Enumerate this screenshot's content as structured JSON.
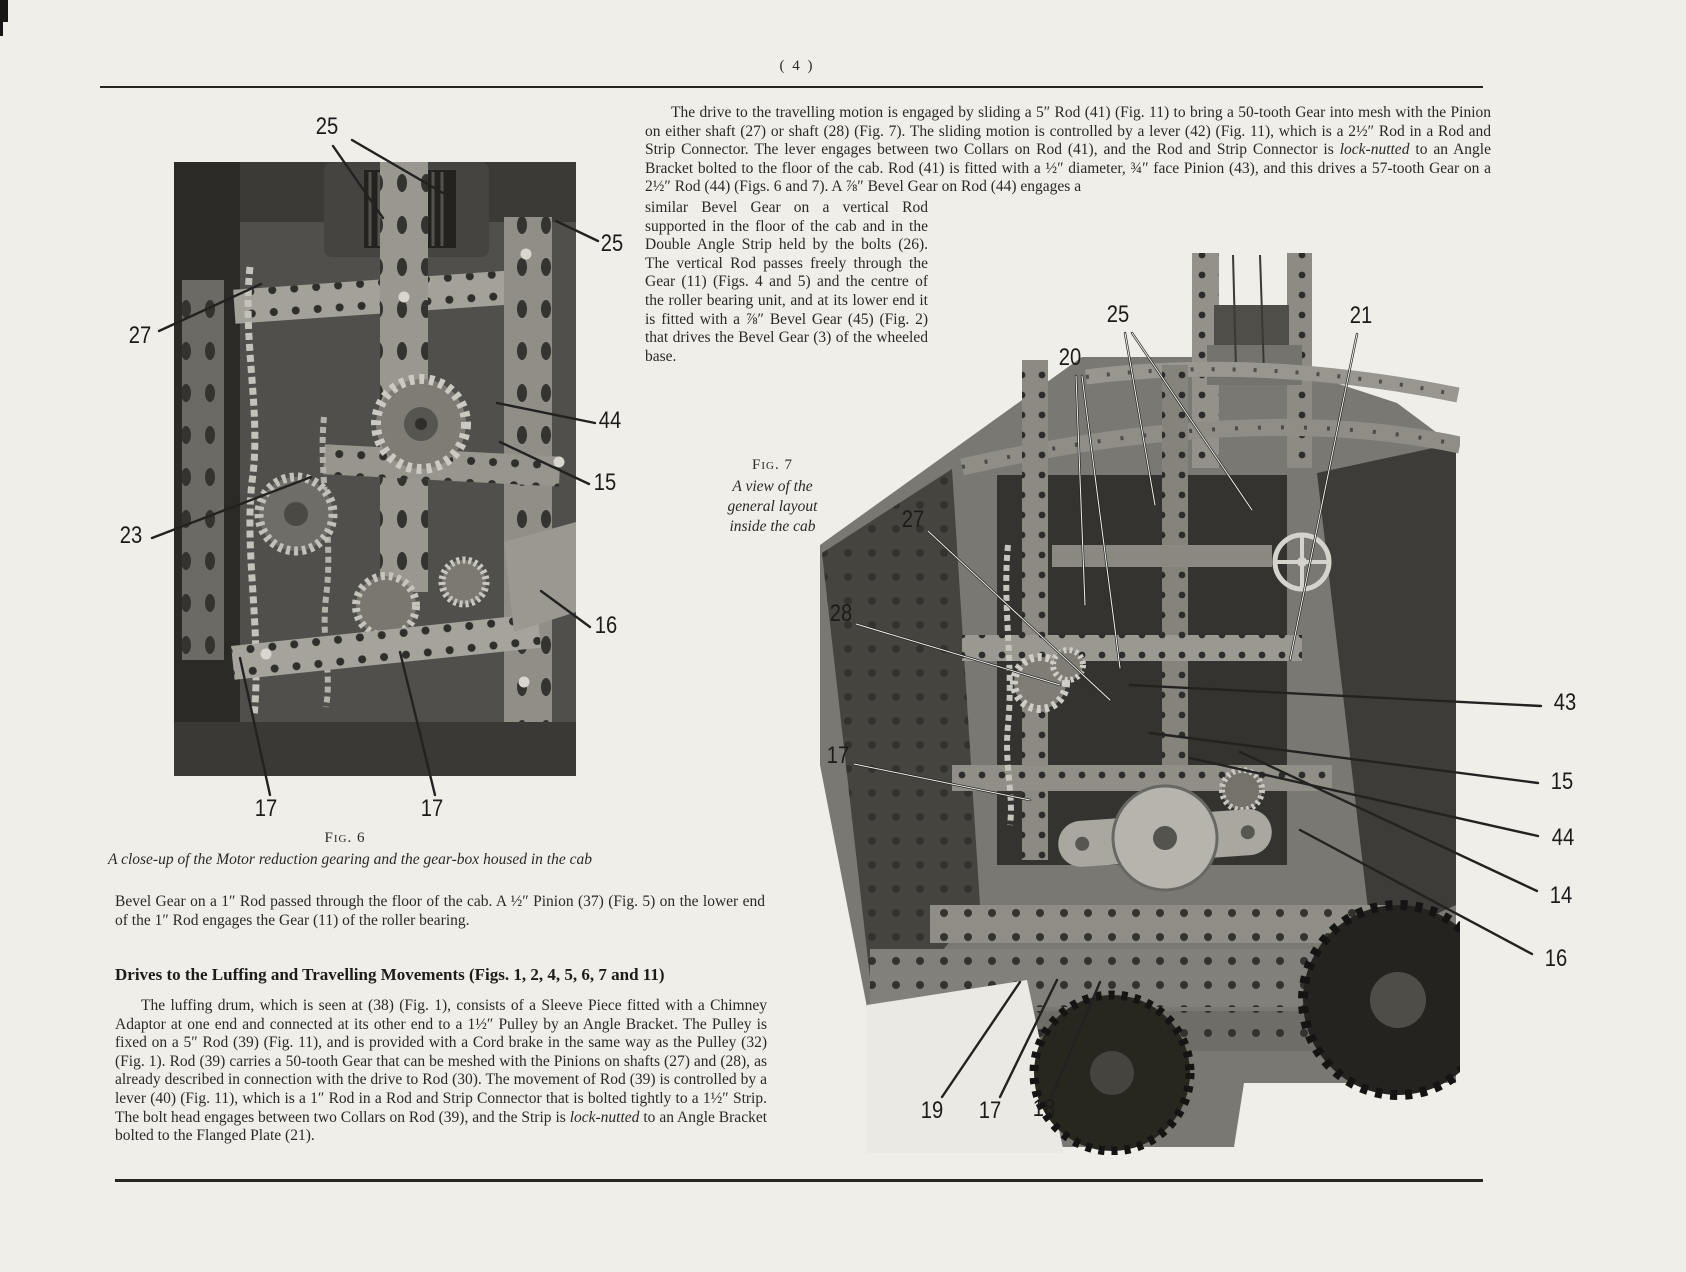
{
  "page": {
    "number": "( 4 )"
  },
  "right_column": {
    "para_wide": "The drive to the travelling motion is engaged by sliding a 5″ Rod (41) (Fig. 11) to bring a 50-tooth Gear into mesh with the Pinion on either shaft (27) or shaft (28) (Fig. 7). The sliding motion is controlled by a lever (42) (Fig. 11), which is a 2½″ Rod in a Rod and Strip Connector. The lever engages between two Collars on Rod (41), and the Rod and Strip Connector is <i>lock-nutted</i> to an Angle Bracket bolted to the floor of the cab. Rod (41) is fitted with a ½″ diameter, ¾″ face Pinion (43), and this drives a 57-tooth Gear on a 2½″ Rod (44) (Figs. 6 and 7). A ⅞″ Bevel Gear on Rod (44) engages a",
    "para_narrow": "similar Bevel Gear on a vertical Rod supported in the floor of the cab and in the Double Angle Strip held by the bolts (26). The vertical Rod passes freely through the Gear (11) (Figs. 4 and 5) and the centre of the roller bearing unit, and at its lower end it is fitted with a ⅞″ Bevel Gear (45) (Fig. 2) that drives the Bevel Gear (3) of the wheeled base."
  },
  "left_column": {
    "para_bevel": "Bevel Gear on a 1″ Rod passed through the floor of the cab. A ½″ Pinion (37) (Fig. 5) on the lower end of the 1″ Rod engages the Gear (11) of the roller bearing.",
    "heading": "Drives to the Luffing and Travelling Movements (Figs. 1, 2, 4, 5, 6, 7 and 11)",
    "para_luffing": "The luffing drum, which is seen at (38) (Fig. 1), consists of a Sleeve Piece fitted with a Chimney Adaptor at one end and connected at its other end to a 1½″ Pulley by an Angle Bracket. The Pulley is fixed on a 5″ Rod (39) (Fig. 11), and is provided with a Cord brake in the same way as the Pulley (32) (Fig. 1). Rod (39) carries a 50-tooth Gear that can be meshed with the Pinions on shafts (27) and (28), as already described in connection with the drive to Rod (30). The movement of Rod (39) is controlled by a lever (40) (Fig. 11), which is a 1″ Rod in a Rod and Strip Connector that is bolted tightly to a 1½″ Strip. The bolt head engages between two Collars on Rod (39), and the Strip is <i>lock-nutted</i> to an Angle Bracket bolted to the Flanged Plate (21)."
  },
  "fig6": {
    "label": "Fig. 6",
    "caption": "A close-up of the Motor reduction gearing and the gear-box housed in the cab",
    "callouts": [
      {
        "text": "25",
        "x": 327,
        "y": 127,
        "lines": [
          [
            333,
            146,
            383,
            218
          ],
          [
            352,
            140,
            455,
            200
          ]
        ]
      },
      {
        "text": "25",
        "x": 612,
        "y": 244,
        "lines": [
          [
            598,
            241,
            556,
            221
          ]
        ]
      },
      {
        "text": "27",
        "x": 140,
        "y": 336,
        "lines": [
          [
            159,
            331,
            261,
            284
          ]
        ]
      },
      {
        "text": "44",
        "x": 610,
        "y": 421,
        "lines": [
          [
            595,
            423,
            497,
            403
          ]
        ]
      },
      {
        "text": "15",
        "x": 605,
        "y": 483,
        "lines": [
          [
            589,
            484,
            500,
            442
          ]
        ]
      },
      {
        "text": "23",
        "x": 131,
        "y": 536,
        "lines": [
          [
            152,
            538,
            311,
            477
          ]
        ]
      },
      {
        "text": "16",
        "x": 606,
        "y": 626,
        "lines": [
          [
            590,
            627,
            541,
            591
          ]
        ]
      },
      {
        "text": "17",
        "x": 266,
        "y": 809,
        "lines": [
          [
            270,
            795,
            240,
            658
          ]
        ]
      },
      {
        "text": "17",
        "x": 432,
        "y": 809,
        "lines": [
          [
            435,
            795,
            400,
            652
          ]
        ]
      }
    ]
  },
  "fig7": {
    "label": "Fig. 7",
    "caption_lines": [
      "A view of the",
      "general layout",
      "inside the cab"
    ],
    "callouts": [
      {
        "text": "25",
        "x": 1118,
        "y": 315,
        "core": true,
        "lines": [
          [
            1125,
            333,
            1155,
            505
          ],
          [
            1132,
            333,
            1252,
            510
          ]
        ]
      },
      {
        "text": "21",
        "x": 1361,
        "y": 316,
        "core": true,
        "lines": [
          [
            1357,
            334,
            1290,
            660
          ]
        ]
      },
      {
        "text": "20",
        "x": 1070,
        "y": 358,
        "core": true,
        "lines": [
          [
            1076,
            376,
            1085,
            605
          ],
          [
            1082,
            376,
            1120,
            668
          ]
        ]
      },
      {
        "text": "27",
        "x": 913,
        "y": 520,
        "core": true,
        "lines": [
          [
            928,
            531,
            1110,
            700
          ]
        ]
      },
      {
        "text": "28",
        "x": 841,
        "y": 614,
        "core": true,
        "lines": [
          [
            856,
            624,
            1060,
            685
          ]
        ]
      },
      {
        "text": "17",
        "x": 838,
        "y": 756,
        "core": true,
        "lines": [
          [
            854,
            764,
            1030,
            800
          ]
        ]
      },
      {
        "text": "43",
        "x": 1565,
        "y": 703,
        "lines": [
          [
            1541,
            706,
            1130,
            685
          ]
        ]
      },
      {
        "text": "15",
        "x": 1562,
        "y": 782,
        "lines": [
          [
            1538,
            783,
            1150,
            733
          ]
        ]
      },
      {
        "text": "44",
        "x": 1563,
        "y": 838,
        "lines": [
          [
            1538,
            836,
            1190,
            758
          ]
        ]
      },
      {
        "text": "14",
        "x": 1561,
        "y": 896,
        "lines": [
          [
            1537,
            891,
            1240,
            752
          ]
        ]
      },
      {
        "text": "16",
        "x": 1556,
        "y": 959,
        "lines": [
          [
            1532,
            954,
            1300,
            830
          ]
        ]
      },
      {
        "text": "19",
        "x": 932,
        "y": 1111,
        "lines": [
          [
            942,
            1097,
            1020,
            982
          ]
        ]
      },
      {
        "text": "17",
        "x": 990,
        "y": 1111,
        "lines": [
          [
            1000,
            1097,
            1057,
            980
          ]
        ]
      },
      {
        "text": "18",
        "x": 1044,
        "y": 1109,
        "lines": [
          [
            1052,
            1096,
            1100,
            982
          ]
        ]
      }
    ]
  }
}
